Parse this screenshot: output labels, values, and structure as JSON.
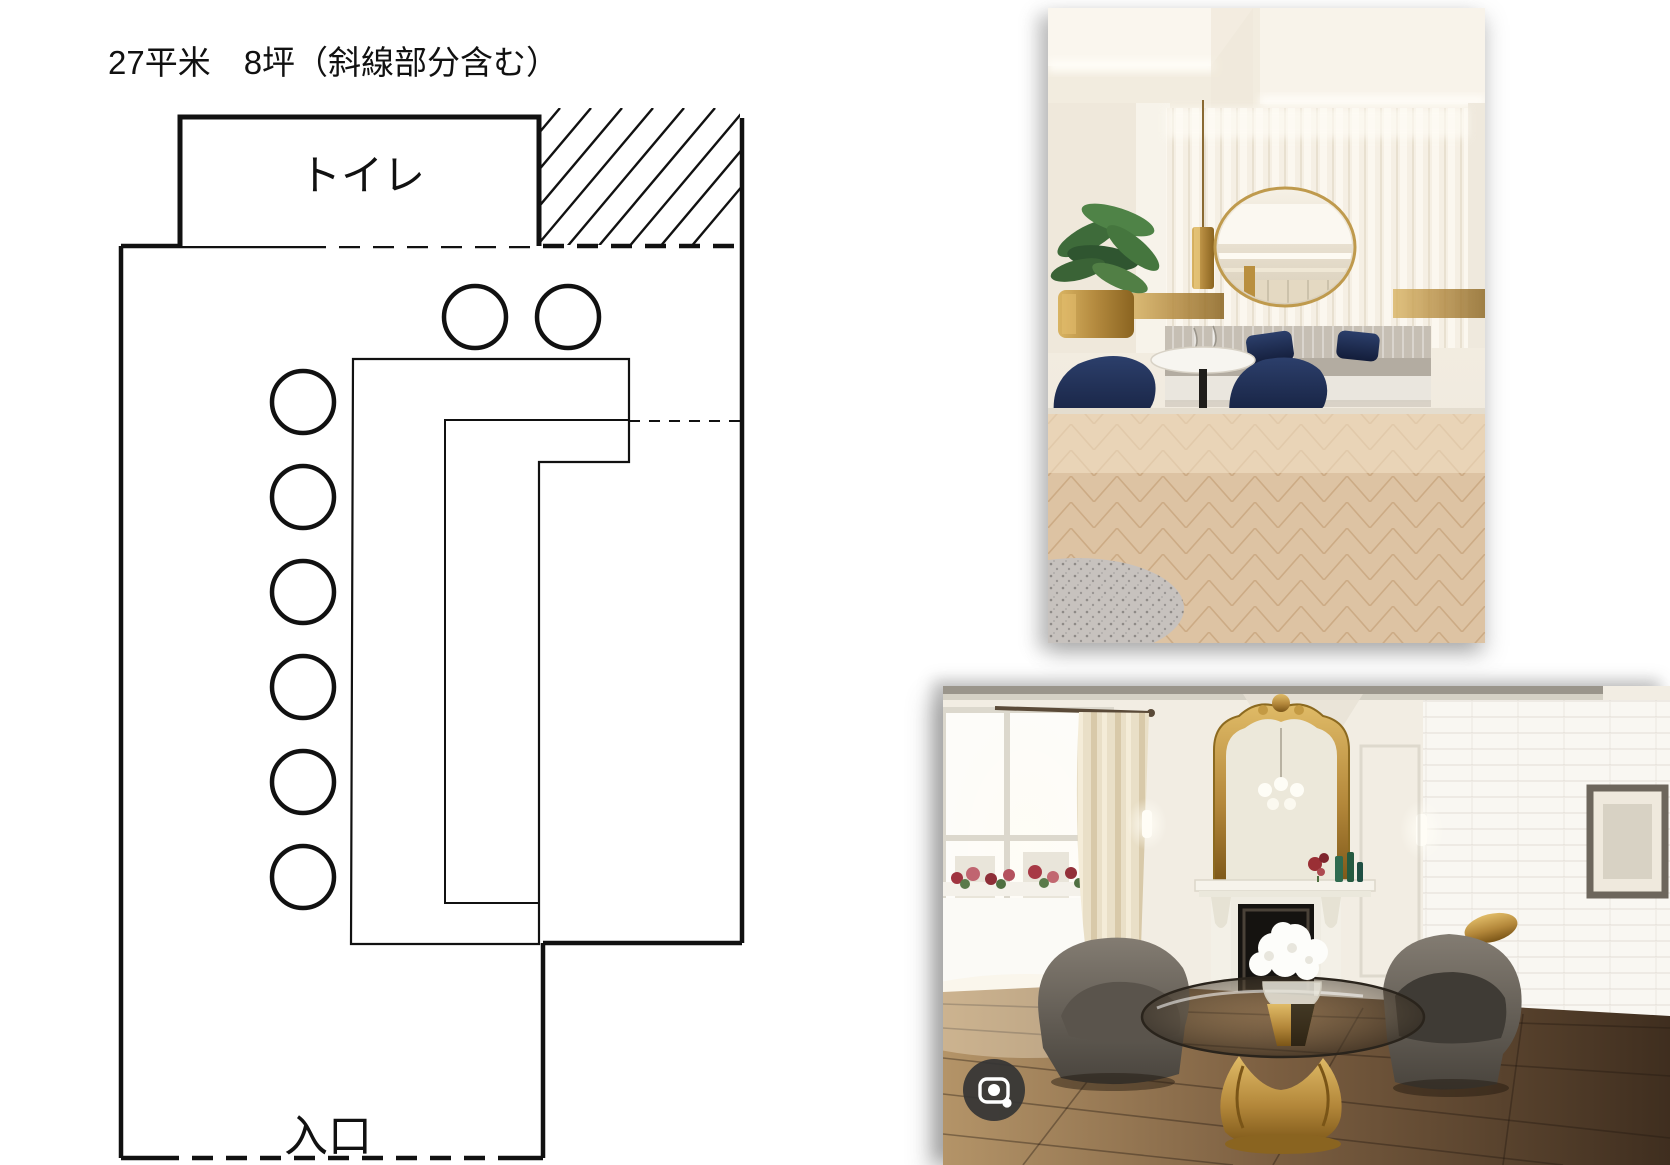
{
  "canvas": {
    "width": 1670,
    "height": 1165,
    "background": "#ffffff"
  },
  "floor_plan": {
    "title": "27平米　8坪（斜線部分含む）",
    "toilet_label": "トイレ",
    "entrance_label": "入口",
    "seats": {
      "top_row": 2,
      "left_column": 6,
      "total": 8
    },
    "line_color": "#111111",
    "fill_color": "#ffffff"
  },
  "photo_top": {
    "name": "lounge-interior-photo",
    "icons": [],
    "palette": {
      "wall": "#f1ebe1",
      "ceiling": "#faf6ee",
      "floor_wood": "#ddc3a3",
      "brass": "#b3893e",
      "navy_chair": "#1c2a4d",
      "bench_gray": "#b5aea4",
      "rug_gray": "#c7c2be"
    }
  },
  "photo_bottom": {
    "name": "sitting-room-interior-photo",
    "icons": [
      "camera-lens-icon"
    ],
    "palette": {
      "wall": "#f2ede3",
      "floor_dark": "#4a3728",
      "floor_light": "#b49468",
      "gold": "#c09a44",
      "velvet_chair": "#6f6a62",
      "fireplace": "#151310",
      "lens_bg": "#3a3a3a",
      "lens_glyph": "#ffffff"
    }
  }
}
